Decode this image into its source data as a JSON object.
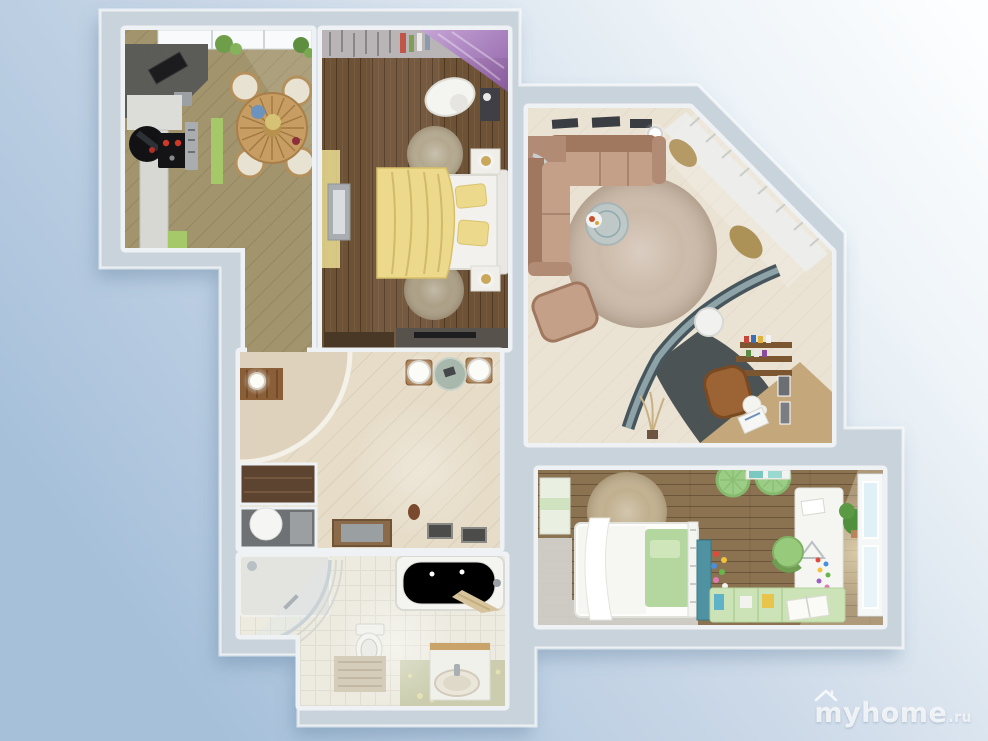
{
  "watermark": {
    "name": "myhome",
    "tld": ".ru",
    "icon": "house-roof-icon"
  },
  "palette": {
    "bg_left": "#a6c0da",
    "bg_mid": "#ccd9e8",
    "bg_top_right": "#fdfeff",
    "wall_outer": "#c9d3db",
    "wall_inner": "#eef2f4",
    "kitchen_floor": "#a2946c",
    "bedroom_floor": "#6e5236",
    "living_floor": "#eae2d3",
    "hallway_floor": "#e6dcc8",
    "bathroom_floor": "#edebe0",
    "bathroom_green_floor": "#cbcdae",
    "kids_floor": "#8b7251",
    "living_rug": "#ccbaa9",
    "kids_rug": "#c1b08f",
    "sofa": "#c4a089",
    "bed_blanket": "#ecd98b",
    "crib_mattress": "#b4d79f",
    "pouf": "#9ccd86",
    "kitchen_accent": "#a5c868",
    "table_wood": "#c89d63",
    "canopy": "#a678b8"
  }
}
